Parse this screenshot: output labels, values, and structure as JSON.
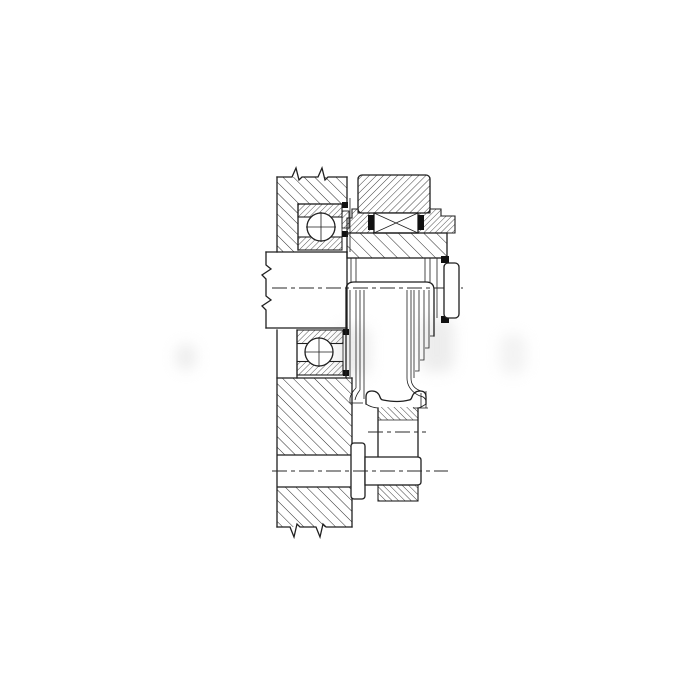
{
  "meta": {
    "kind": "technical-drawing",
    "description": "Black-and-white cross-section engineering drawing of a shaft, bearing and release-cup assembly mounted in a housing wall",
    "background_color": "#ffffff",
    "line_color": "#1f1f1f",
    "hatch_color": "#2a2a2a",
    "watermark_color": "#d7d7d7"
  },
  "parts": [
    {
      "id": "housing-wall",
      "label": "Housing wall (sectioned, diagonal hatch, with break symbols)"
    },
    {
      "id": "drive-shaft",
      "label": "Drive shaft with break symbols and center line"
    },
    {
      "id": "upper-ball-bearing",
      "label": "Upper deep-groove ball bearing"
    },
    {
      "id": "lower-ball-bearing",
      "label": "Lower deep-groove ball bearing"
    },
    {
      "id": "gear-ring",
      "label": "Gear / pulley ring (sectioned)"
    },
    {
      "id": "roller-bearing",
      "label": "Needle roller bearing with side seals"
    },
    {
      "id": "bearing-hub",
      "label": "Bearing hub sleeve (sectioned)"
    },
    {
      "id": "end-cap",
      "label": "Shaft end cap with retaining seals"
    },
    {
      "id": "release-cup",
      "label": "Stepped release cup / bell"
    },
    {
      "id": "spool-follower",
      "label": "Spool-shaped follower with waist section"
    },
    {
      "id": "mounting-pin",
      "label": "Mounting pin with flange and center line"
    },
    {
      "id": "lock-nut",
      "label": "Sectioned nut below mounting pin"
    },
    {
      "id": "watermark",
      "label": "Faint gray watermark blobs"
    }
  ]
}
